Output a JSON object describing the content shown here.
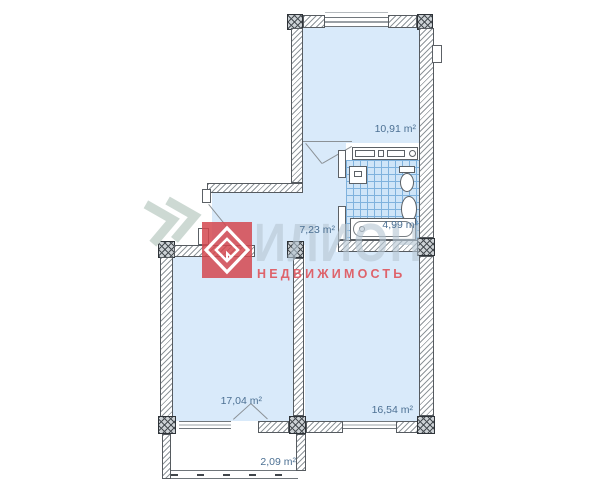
{
  "floor_plan": {
    "rooms": [
      {
        "name": "room-top",
        "area_label": "10,91 m²"
      },
      {
        "name": "hallway",
        "area_label": "7,23 m²"
      },
      {
        "name": "bathroom",
        "area_label": "4,99 m²"
      },
      {
        "name": "room-lower-left",
        "area_label": "17,04 m²"
      },
      {
        "name": "room-lower-right",
        "area_label": "16,54 m²"
      },
      {
        "name": "balcony",
        "area_label": "2,09 m²"
      }
    ],
    "colors": {
      "room_fill": "#d9eafa",
      "tile_fill": "#cfe5f8",
      "tile_grid": "#7fb2dd",
      "label_text": "#4c7093",
      "wall_hatch": "#8f969b"
    }
  },
  "watermark": {
    "brand": "ИЛИОН",
    "tagline": "НЕДВИЖИМОСТЬ",
    "logo_color": "#d3484f",
    "tagline_color": "#de5c63",
    "brand_color": "#b7c7d3",
    "chevron_color": "#cdd9d3"
  }
}
